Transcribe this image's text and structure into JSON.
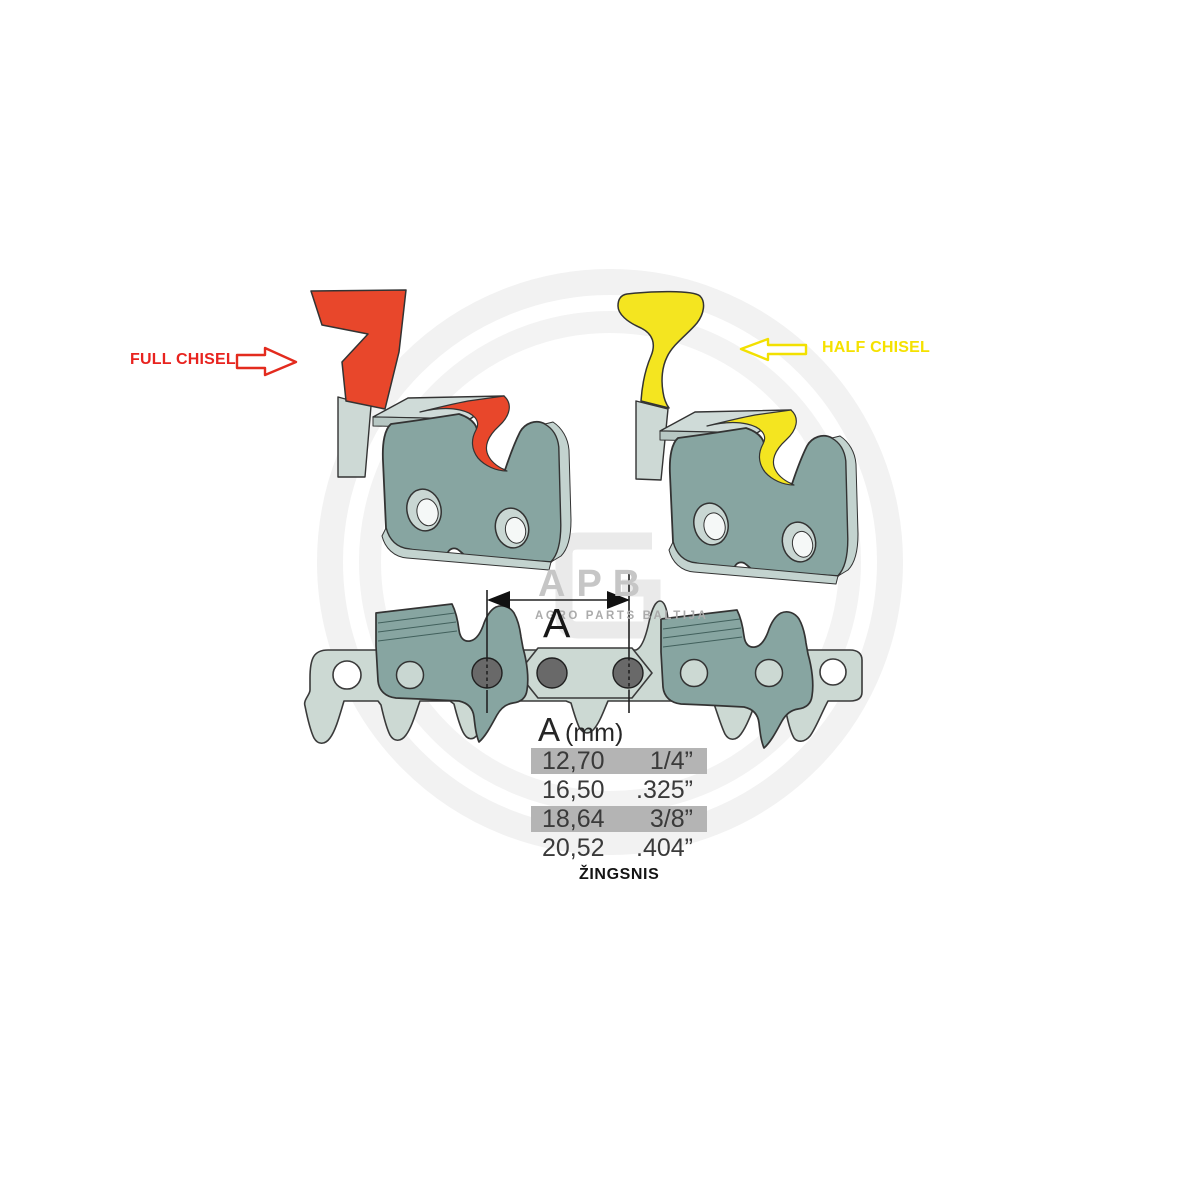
{
  "labels": {
    "full_chisel": "FULL CHISEL",
    "half_chisel": "HALF CHISEL"
  },
  "watermark": {
    "brand": "APB",
    "subtitle": "AGRO PARTS BALTIJA"
  },
  "dimension": {
    "letter": "A"
  },
  "pitch_table": {
    "header_letter": "A",
    "header_unit": "(mm)",
    "rows": [
      {
        "mm": "12,70",
        "inch": "1/4”",
        "highlighted": true
      },
      {
        "mm": "16,50",
        "inch": ".325”",
        "highlighted": false
      },
      {
        "mm": "18,64",
        "inch": "3/8”",
        "highlighted": true
      },
      {
        "mm": "20,52",
        "inch": ".404”",
        "highlighted": false
      }
    ],
    "caption": "ŽINGSNIS"
  },
  "colors": {
    "full_chisel_red": "#e8472b",
    "half_chisel_yellow": "#f4e520",
    "label_red": "#e8231f",
    "label_yellow": "#f5e100",
    "row_highlight_gray": "#b4b4b4",
    "chain_dark_teal": "#87a5a1",
    "chain_light_sage": "#ccd9d3"
  }
}
